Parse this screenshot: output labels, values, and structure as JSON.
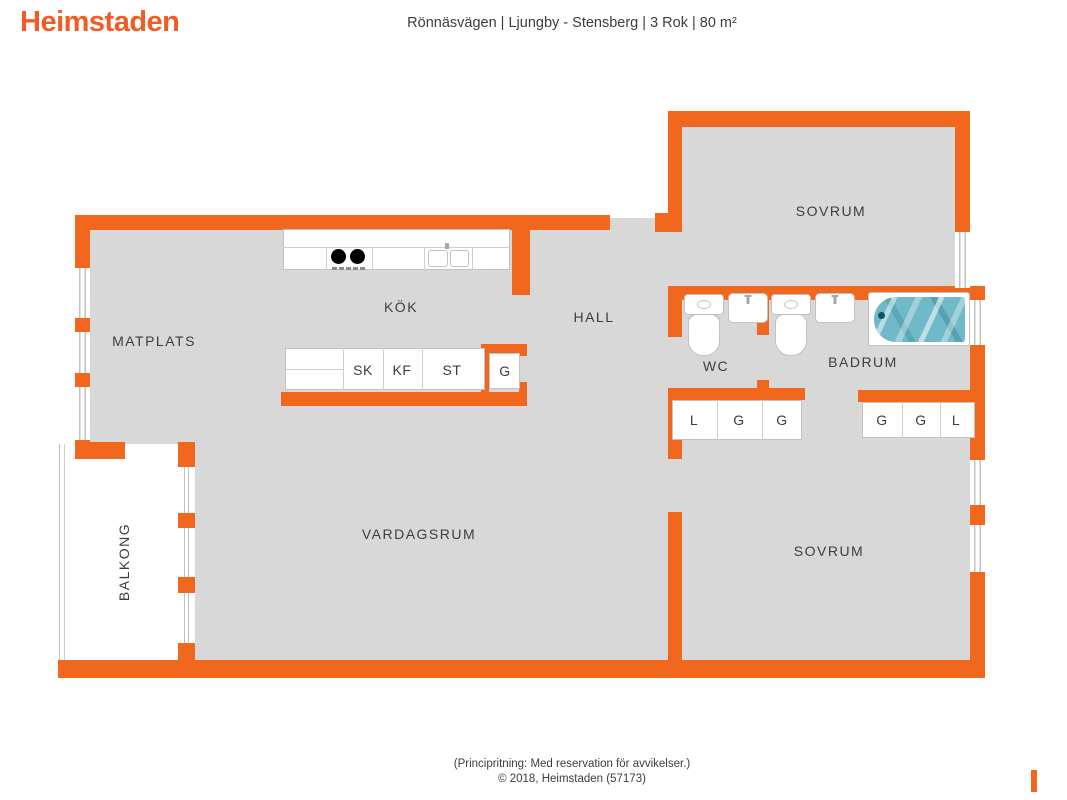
{
  "header": {
    "logo": "Heimstaden",
    "title": "Rönnäsvägen | Ljungby - Stensberg | 3 Rok | 80 m²"
  },
  "rooms": {
    "sovrum_top": "SOVRUM",
    "matplats": "MATPLATS",
    "kok": "KÖK",
    "hall": "HALL",
    "wc": "WC",
    "badrum": "BADRUM",
    "vardagsrum": "VARDAGSRUM",
    "sovrum_bottom": "SOVRUM",
    "balkong": "BALKONG"
  },
  "fixtures": {
    "kitchen_cabinets": [
      "SK",
      "KF",
      "ST"
    ],
    "kitchen_tall_cabinet": "G",
    "wc_cabinets": [
      "L",
      "G",
      "G"
    ],
    "badrum_cabinets": [
      "G",
      "G",
      "L"
    ]
  },
  "footer": {
    "disclaimer": "(Principritning: Med reservation för avvikelser.)",
    "copyright": "© 2018, Heimstaden (57173)"
  },
  "colors": {
    "wall": "#F2671E",
    "floor": "#D8D8D8",
    "logo": "#F15B24",
    "text": "#3D3D3D",
    "fixture_outline": "#C2C2C2",
    "water": "#6FB9C8"
  }
}
